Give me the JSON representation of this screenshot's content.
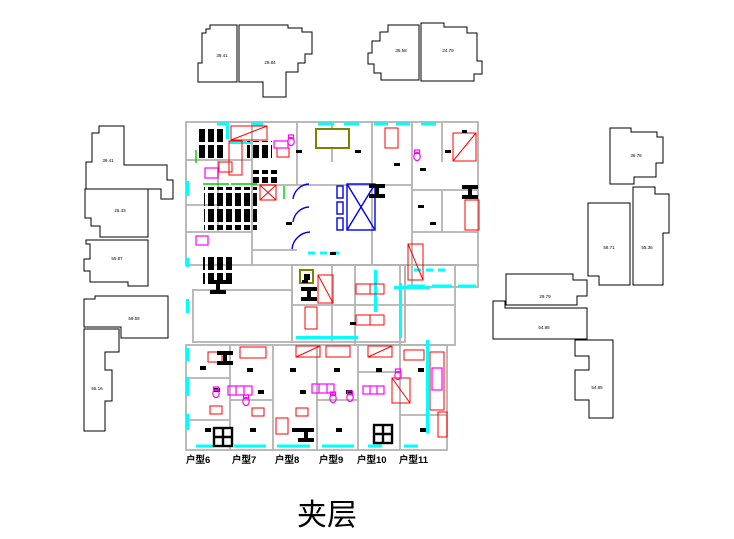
{
  "title": "夹层",
  "unit_labels": [
    "户型6",
    "户型7",
    "户型8",
    "户型9",
    "户型10",
    "户型11"
  ],
  "area_labels": [
    "39.41",
    "29.84",
    "35.58",
    "24.79",
    "39.41",
    "25.43",
    "55.87",
    "59.59",
    "55.16",
    "36.78",
    "58.71",
    "55.36",
    "29.79",
    "54.88",
    "54.85"
  ],
  "colors": {
    "background": "#ffffff",
    "outline_black": "#000000",
    "wall_gray": "#b2b2b2",
    "window_cyan": "#00ffff",
    "stair_red": "#ff0000",
    "fixture_magenta": "#ff00ff",
    "elevator_blue": "#0000ee",
    "accent_green": "#00cc00",
    "skylight_olive": "#7f7f00"
  }
}
